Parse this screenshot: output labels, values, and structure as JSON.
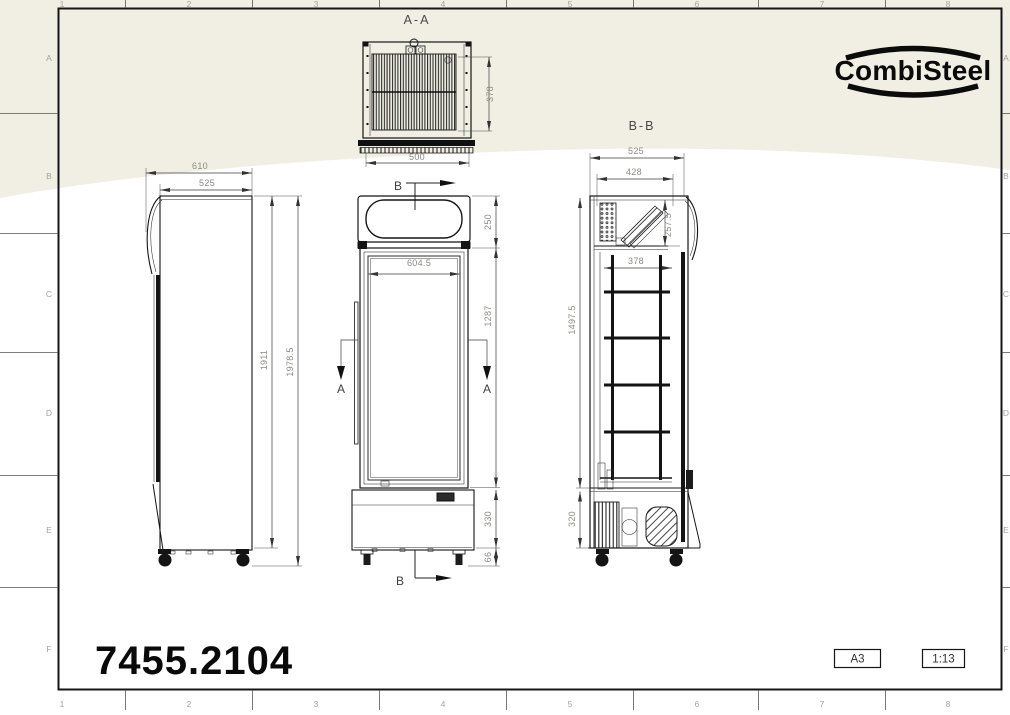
{
  "colors": {
    "paper_tint": "#f1eee4",
    "drawing_line": "#151515",
    "dimension_text": "#8b8a83",
    "zone_text": "#a6a39a",
    "section_label_text": "#3f3e3a"
  },
  "title_block": {
    "brand": "CombiSteel",
    "article_number": "7455.2104",
    "paper_size": "A3",
    "scale": "1:13"
  },
  "border": {
    "columns_top": [
      "1",
      "2",
      "3",
      "4",
      "5",
      "6",
      "7",
      "8"
    ],
    "columns_bottom": [
      "1",
      "2",
      "3",
      "4",
      "5",
      "6",
      "7",
      "8"
    ],
    "rows_left": [
      "A",
      "B",
      "C",
      "D",
      "E",
      "F"
    ],
    "rows_right": [
      "A",
      "B",
      "C",
      "D",
      "E",
      "F"
    ]
  },
  "views": {
    "section_top": {
      "title": "A-A",
      "dim_condenser_depth": "378",
      "dim_condenser_width": "500"
    },
    "front": {
      "section_mark_top": "B",
      "section_mark_bottom": "B",
      "section_mark_left": "A",
      "section_mark_right": "A",
      "dim_canopy_height": "250",
      "dim_glass_width": "604.5",
      "dim_door_height": "1287",
      "dim_base_height": "330",
      "dim_leg_height": "66"
    },
    "side": {
      "dim_total_depth": "610",
      "dim_body_depth": "525",
      "dim_body_height": "1911",
      "dim_total_height": "1978.5"
    },
    "section_side": {
      "title": "B-B",
      "dim_total_depth": "525",
      "dim_inner_depth": "428",
      "dim_top_unit_height": "257.5",
      "dim_shelf_depth": "378",
      "dim_inner_height": "1497.5",
      "dim_machine_height": "320"
    }
  }
}
